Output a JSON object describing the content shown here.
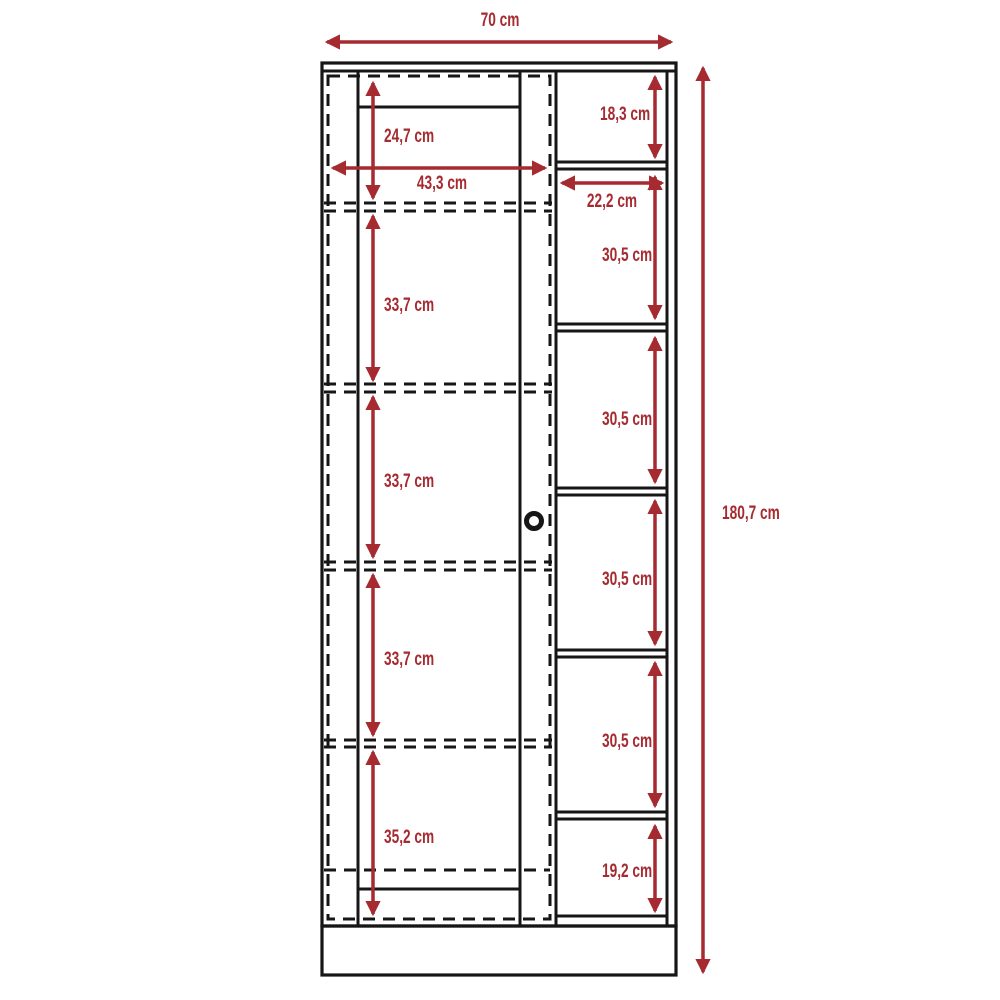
{
  "diagram": {
    "kind": "furniture dimension drawing (two-door side / shelf column wardrobe)",
    "unit": "cm",
    "overall_width": "70 cm",
    "overall_height": "180,7 cm",
    "door_section": {
      "inner_width": "43,3 cm",
      "sections_top_to_bottom": [
        "24,7 cm",
        "33,7 cm",
        "33,7 cm",
        "33,7 cm",
        "35,2 cm"
      ]
    },
    "shelf_column": {
      "inner_width": "22,2 cm",
      "sections_top_to_bottom": [
        "18,3 cm",
        "30,5 cm",
        "30,5 cm",
        "30,5 cm",
        "30,5 cm",
        "19,2 cm"
      ]
    }
  },
  "colors": {
    "dimension_red": "#A62B31",
    "line_black": "#161616",
    "background": "#FFFFFF"
  }
}
